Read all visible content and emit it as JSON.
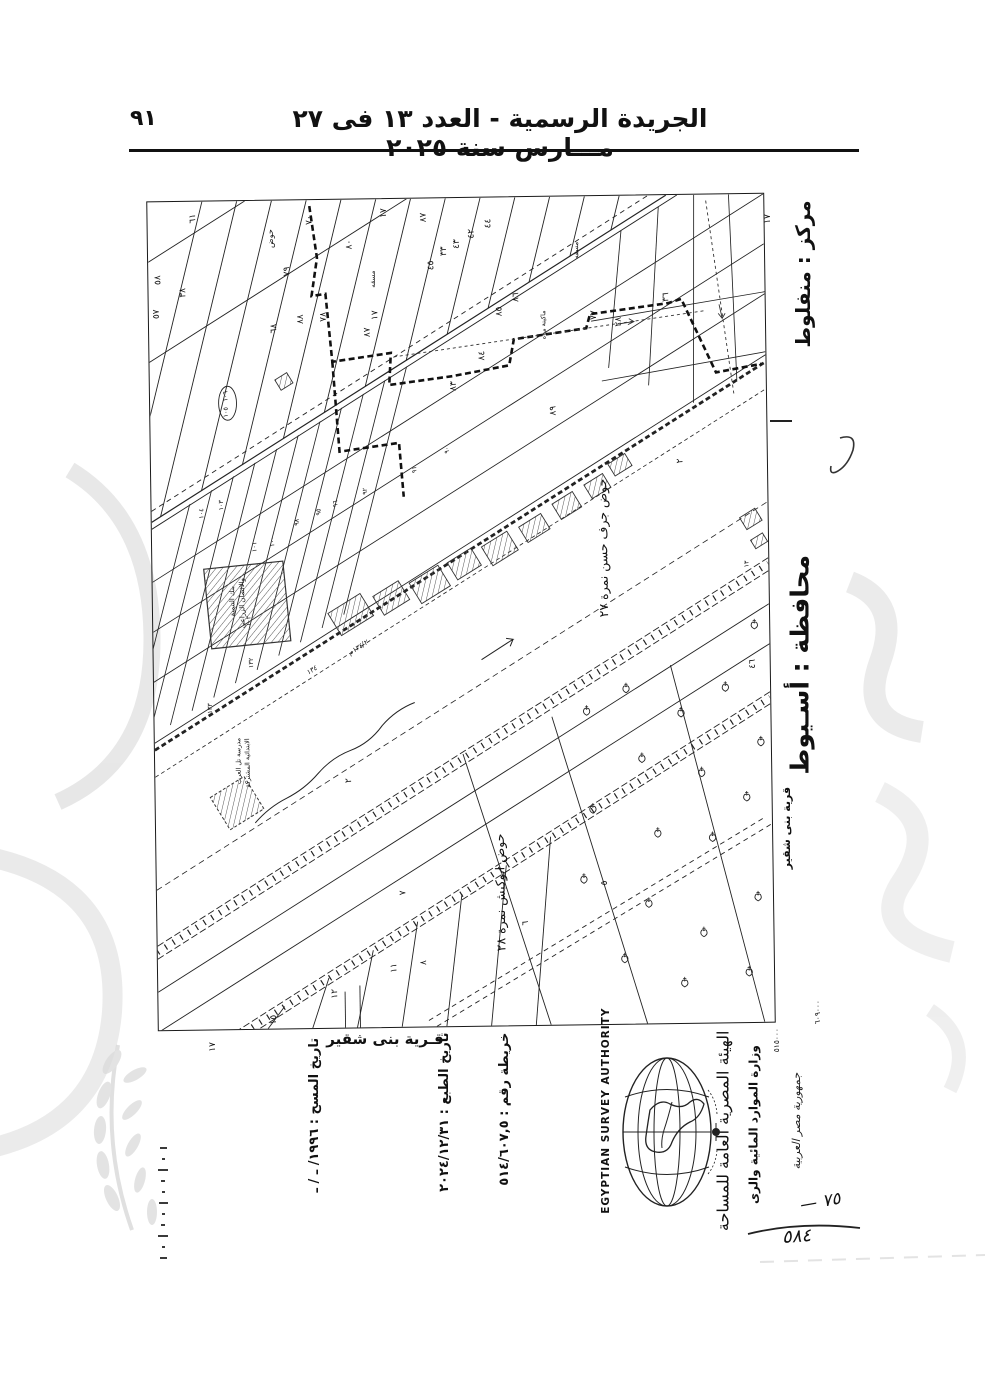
{
  "page": {
    "header": {
      "title": "الجريدة الرسمية - العدد ١٣ فى ٢٧ مـــارس سنة ٢٠٢٥",
      "page_number": "٩١"
    }
  },
  "map_margins": {
    "markaz": "مركز : منفلوط",
    "governorate": "محافظة : أسـيوط",
    "village_side": "قرية بنى شقير",
    "village_bottom": "قـرية بنى شقير",
    "tick_top_right": "١٧",
    "tick_bottom_left": "١٧",
    "grid_easting": "٦٠٩٠٠٠",
    "grid_northing": "٥١٥٠٠٠"
  },
  "footer": {
    "map_no": "خريطة رقم : ٥١٤/٦٠٧,٥",
    "print_date": "تاريخ الطبع : ٢٠٢٤/١٢/٣١",
    "survey_date": "تاريخ المسح : ١٩٩٦/ ـ / ـ",
    "authority_en": "EGYPTIAN SURVEY AUTHORITY",
    "ministry_ar": "وزارة الموارد المائية والرى",
    "authority_ar": "الهيئة المصرية العامة للمساحة",
    "handwritten_note": "جمهورية مصر العربية",
    "handwritten_75": "— ٧٥",
    "handwritten_584": "٥٨٤"
  },
  "map": {
    "hawd_labels": [
      {
        "text": "حوض جرف حسن نمرة ٢٧",
        "x": 458,
        "y": 352,
        "fs": 12.5
      },
      {
        "text": "حوض ابوكبش نمرة ٢٨",
        "x": 350,
        "y": 695,
        "fs": 12.5
      }
    ],
    "poi_labels": [
      {
        "text": "بنك التنمية",
        "x": 82,
        "y": 400,
        "fs": 7
      },
      {
        "text": "والائتمان الزراعى",
        "x": 92,
        "y": 402,
        "fs": 7
      },
      {
        "text": "مدرسة تل العرب",
        "x": 86,
        "y": 560,
        "fs": 6.5
      },
      {
        "text": "الابتدائية المشتركة",
        "x": 95,
        "y": 562,
        "fs": 6.5
      },
      {
        "text": "ماكينة مياه",
        "x": 399,
        "y": 128,
        "fs": 6.5
      },
      {
        "text": "مسقه",
        "x": 228,
        "y": 80,
        "fs": 7
      },
      {
        "text": "مسقه",
        "x": 433,
        "y": 54,
        "fs": 7
      },
      {
        "text": "حوض",
        "x": 126,
        "y": 38,
        "fs": 8
      }
    ],
    "hw_labels": [
      {
        "text": "١٣٤/٢م",
        "x": 207,
        "y": 450,
        "rot": -32,
        "fs": 7
      },
      {
        "text": "١٣٤",
        "x": 160,
        "y": 472,
        "rot": -32,
        "fs": 7
      }
    ],
    "oval_numbers": {
      "top": "١٠٦",
      "bottom": "١٠٥"
    },
    "parcel_numbers": [
      {
        "v": "٦١",
        "x": 48,
        "y": 17
      },
      {
        "v": "٧٠",
        "x": 165,
        "y": 20
      },
      {
        "v": "١٧",
        "x": 240,
        "y": 14
      },
      {
        "v": "٨٧",
        "x": 280,
        "y": 19
      },
      {
        "v": "٤٤",
        "x": 345,
        "y": 26
      },
      {
        "v": "٤٢",
        "x": 328,
        "y": 36
      },
      {
        "v": "٤٣",
        "x": 313,
        "y": 46
      },
      {
        "v": "٣٣",
        "x": 300,
        "y": 53
      },
      {
        "v": "٤٥",
        "x": 287,
        "y": 67
      },
      {
        "v": "٨٠",
        "x": 205,
        "y": 45
      },
      {
        "v": "٧٩",
        "x": 142,
        "y": 71
      },
      {
        "v": "٥٨",
        "x": 12,
        "y": 78
      },
      {
        "v": "٣٨",
        "x": 37,
        "y": 91
      },
      {
        "v": "٥٧",
        "x": 10,
        "y": 112
      },
      {
        "v": "٦٨",
        "x": 128,
        "y": 128
      },
      {
        "v": "٨٨",
        "x": 155,
        "y": 119
      },
      {
        "v": "٧٨",
        "x": 178,
        "y": 117
      },
      {
        "v": "١٧",
        "x": 230,
        "y": 116
      },
      {
        "v": "٨٧",
        "x": 222,
        "y": 133
      },
      {
        "v": "٨٦",
        "x": 372,
        "y": 100
      },
      {
        "v": "٨٥",
        "x": 355,
        "y": 114
      },
      {
        "v": "٨٤",
        "x": 337,
        "y": 158
      },
      {
        "v": "٨٣",
        "x": 308,
        "y": 188
      },
      {
        "v": "٣٦",
        "x": 523,
        "y": 102
      },
      {
        "v": "٧٧",
        "x": 450,
        "y": 119
      },
      {
        "v": "٢٨",
        "x": 475,
        "y": 126
      },
      {
        "v": "٨٩",
        "x": 408,
        "y": 214
      },
      {
        "v": "٩٠",
        "x": 300,
        "y": 252,
        "s": 1
      },
      {
        "v": "٩١",
        "x": 267,
        "y": 271,
        "s": 1
      },
      {
        "v": "٩٢",
        "x": 217,
        "y": 292,
        "s": 1
      },
      {
        "v": "٩٦",
        "x": 187,
        "y": 304,
        "s": 1
      },
      {
        "v": "٩٥",
        "x": 170,
        "y": 312,
        "s": 1
      },
      {
        "v": "٩٨",
        "x": 148,
        "y": 322,
        "s": 1
      },
      {
        "v": "١٠٠",
        "x": 123,
        "y": 341,
        "s": 1
      },
      {
        "v": "١٠١",
        "x": 105,
        "y": 346,
        "s": 1
      },
      {
        "v": "١٠٣",
        "x": 72,
        "y": 304,
        "s": 1
      },
      {
        "v": "١٠٤",
        "x": 52,
        "y": 312,
        "s": 1
      },
      {
        "v": "١٠٢",
        "x": 98,
        "y": 420,
        "s": 1
      },
      {
        "v": "١٣٢",
        "x": 100,
        "y": 462,
        "s": 1
      },
      {
        "v": "١٣٣",
        "x": 58,
        "y": 507,
        "s": 1
      },
      {
        "v": "٢",
        "x": 535,
        "y": 266
      },
      {
        "v": "٢",
        "x": 197,
        "y": 581
      },
      {
        "v": "١٣",
        "x": 600,
        "y": 370,
        "s": 1
      },
      {
        "v": "٤٦",
        "x": 605,
        "y": 470
      },
      {
        "v": "٥",
        "x": 453,
        "y": 687
      },
      {
        "v": "٦",
        "x": 373,
        "y": 726
      },
      {
        "v": "٧",
        "x": 250,
        "y": 694
      },
      {
        "v": "٨",
        "x": 270,
        "y": 764
      },
      {
        "v": "١١",
        "x": 240,
        "y": 769
      },
      {
        "v": "١٢",
        "x": 180,
        "y": 794
      },
      {
        "v": "١٥",
        "x": 118,
        "y": 819
      }
    ],
    "buildings": [
      [
        180,
        402,
        38,
        26
      ],
      [
        225,
        388,
        30,
        22
      ],
      [
        262,
        374,
        34,
        24
      ],
      [
        300,
        356,
        28,
        20
      ],
      [
        335,
        340,
        30,
        22
      ],
      [
        372,
        322,
        26,
        18
      ],
      [
        406,
        300,
        24,
        18
      ],
      [
        438,
        282,
        22,
        16
      ],
      [
        462,
        262,
        20,
        14
      ],
      [
        128,
        175,
        14,
        12
      ],
      [
        594,
        318,
        18,
        14
      ],
      [
        604,
        342,
        14,
        10
      ]
    ],
    "trees": [
      [
        435,
        516
      ],
      [
        475,
        494
      ],
      [
        530,
        519
      ],
      [
        490,
        564
      ],
      [
        550,
        579
      ],
      [
        440,
        614
      ],
      [
        505,
        639
      ],
      [
        560,
        644
      ],
      [
        595,
        604
      ],
      [
        610,
        549
      ],
      [
        575,
        494
      ],
      [
        430,
        684
      ],
      [
        495,
        709
      ],
      [
        550,
        739
      ],
      [
        605,
        704
      ],
      [
        470,
        764
      ],
      [
        530,
        789
      ],
      [
        595,
        779
      ],
      [
        605,
        432
      ]
    ]
  }
}
